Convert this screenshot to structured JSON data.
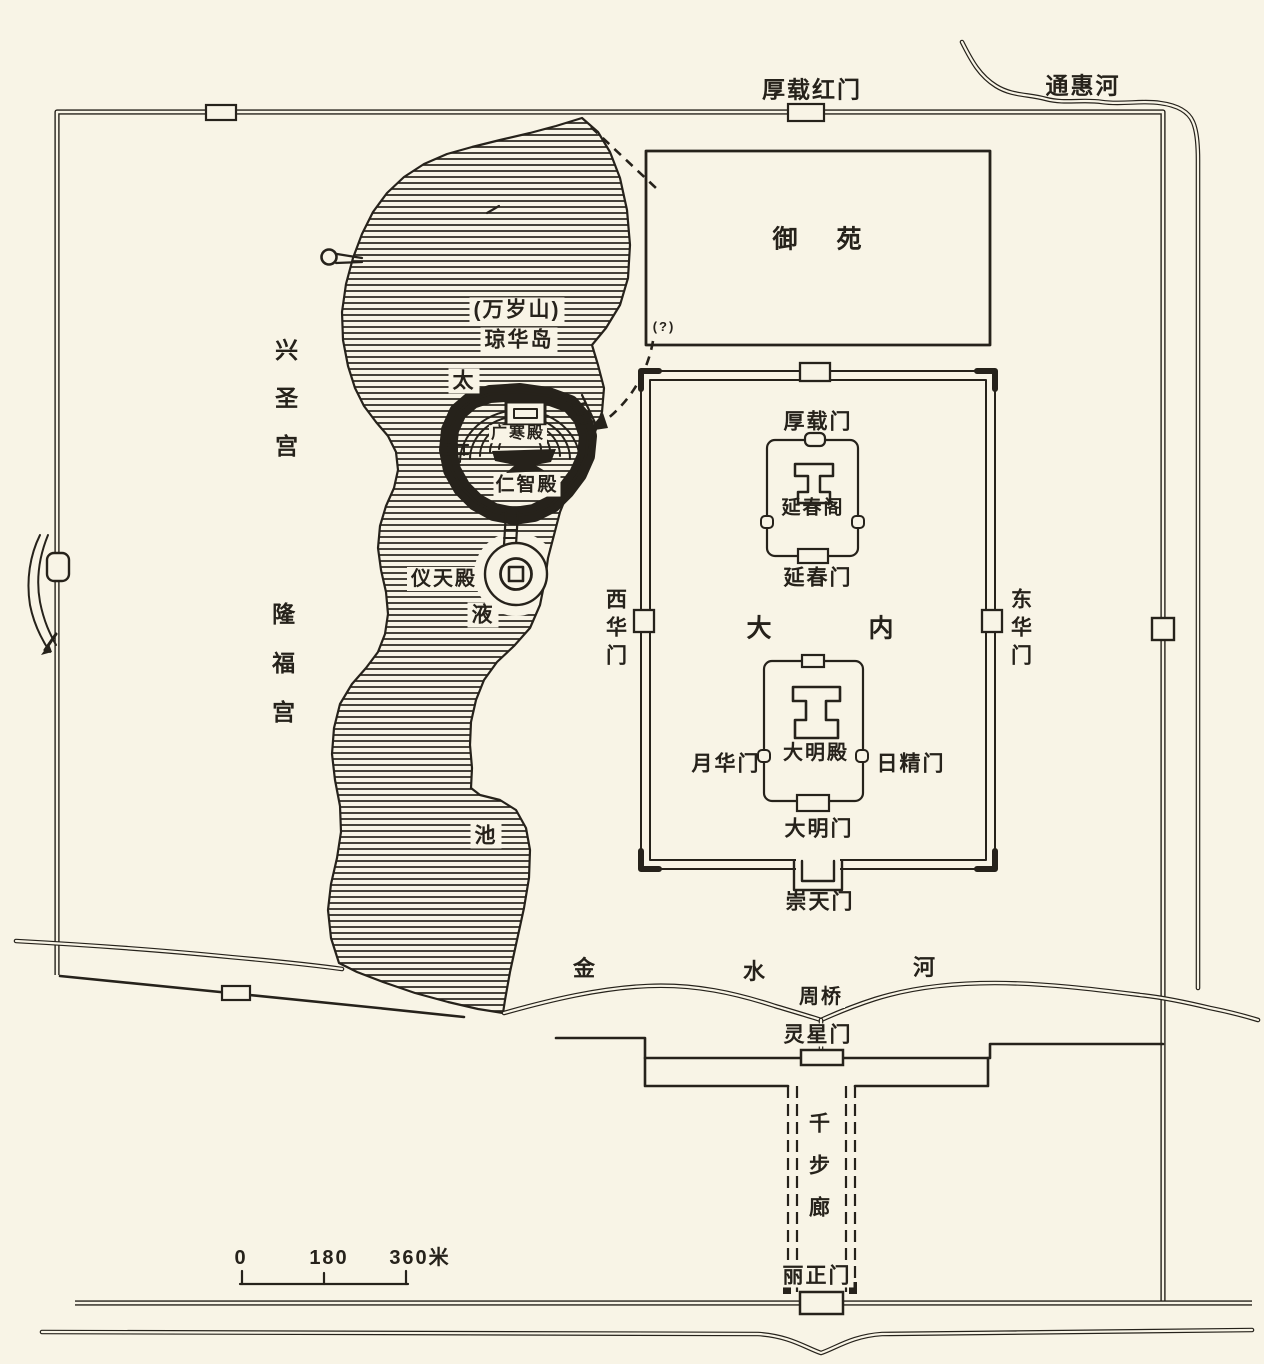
{
  "palette": {
    "background": "#f8f4e6",
    "ink": "#26221b"
  },
  "legend": {
    "scale_ticks": [
      "0",
      "180",
      "360米"
    ]
  },
  "waterways": {
    "tonghui_river": "通惠河",
    "jinshui_river_chars": [
      "金",
      "水",
      "河"
    ],
    "taiye_pond_chars": [
      "太",
      "液",
      "池"
    ],
    "zhou_bridge": "周桥"
  },
  "outer_city": {
    "houzai_red_gate": "厚载红门",
    "lingxing_gate": "灵星门",
    "thousand_step_corridor": "千步廊",
    "lizheng_gate": "丽正门",
    "uncertain_mark": "(?)"
  },
  "imperial_city": {
    "yuyuan_chars": [
      "御",
      "苑"
    ],
    "danei_chars": [
      "大",
      "内"
    ],
    "houzai_gate": "厚载门",
    "chongtian_gate": "崇天门",
    "xihua_gate": "西华门",
    "donghua_gate": "东华门"
  },
  "inner_courts": {
    "yanchun_pavilion": "延春阁",
    "yanchun_gate": "延春门",
    "daming_hall": "大明殿",
    "daming_gate": "大明门",
    "yuehua_gate": "月华门",
    "rijing_gate": "日精门"
  },
  "island": {
    "wansui_hill": "(万岁山)",
    "qionghua_island": "琼华岛",
    "guanghan_hall": "广寒殿",
    "renzhi_hall": "仁智殿",
    "yitian_hall": "仪天殿"
  },
  "west_palaces": {
    "xingsheng_palace": "兴圣宫",
    "longfu_palace": "隆福宫"
  }
}
